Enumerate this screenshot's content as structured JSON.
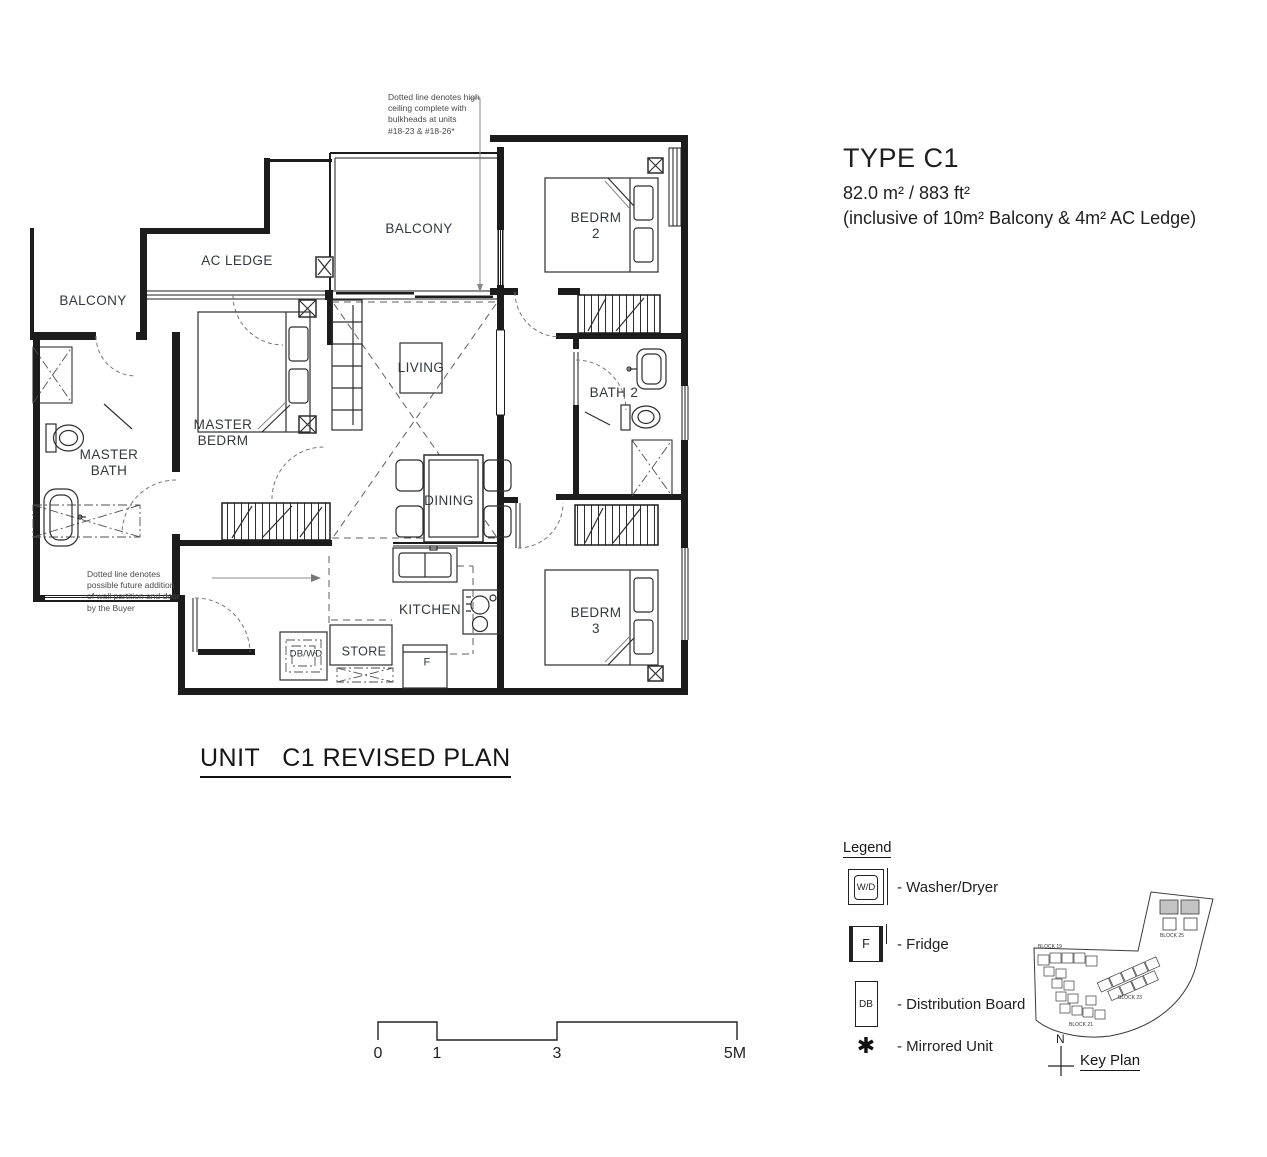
{
  "header": {
    "type_title": "TYPE C1",
    "area": "82.0 m² / 883 ft²",
    "note": "(inclusive of 10m² Balcony & 4m² AC Ledge)"
  },
  "plan_title": "UNIT   C1 REVISED PLAN",
  "annotations": {
    "high_ceiling": "Dotted line denotes high\nceiling complete with\nbulkheads at units\n#18-23 & #18-26*",
    "future_partition": "Dotted line denotes\npossible future addition\nof wall partition and door\nby the Buyer"
  },
  "rooms": {
    "balcony_left": "BALCONY",
    "ac_ledge": "AC LEDGE",
    "balcony_center": "BALCONY",
    "bedrm2": "BEDRM\n2",
    "living": "LIVING",
    "master_bedrm": "MASTER\nBEDRM",
    "master_bath": "MASTER\nBATH",
    "bath2": "BATH 2",
    "dining": "DINING",
    "kitchen": "KITCHEN",
    "bedrm3": "BEDRM\n3",
    "store": "STORE",
    "db_wd": "DB/WD",
    "fridge": "F"
  },
  "legend": {
    "title": "Legend",
    "items": [
      {
        "symbol": "W/D",
        "label": "- Washer/Dryer"
      },
      {
        "symbol": "F",
        "label": "- Fridge"
      },
      {
        "symbol": "DB",
        "label": "- Distribution Board"
      },
      {
        "symbol": "✱",
        "label": "- Mirrored Unit"
      }
    ]
  },
  "key_plan": {
    "title": "Key Plan",
    "north": "N",
    "blocks": [
      "BLOCK 19",
      "BLOCK 21",
      "BLOCK 23",
      "BLOCK 25"
    ]
  },
  "scale": {
    "ticks": [
      "0",
      "1",
      "3",
      "5M"
    ]
  }
}
